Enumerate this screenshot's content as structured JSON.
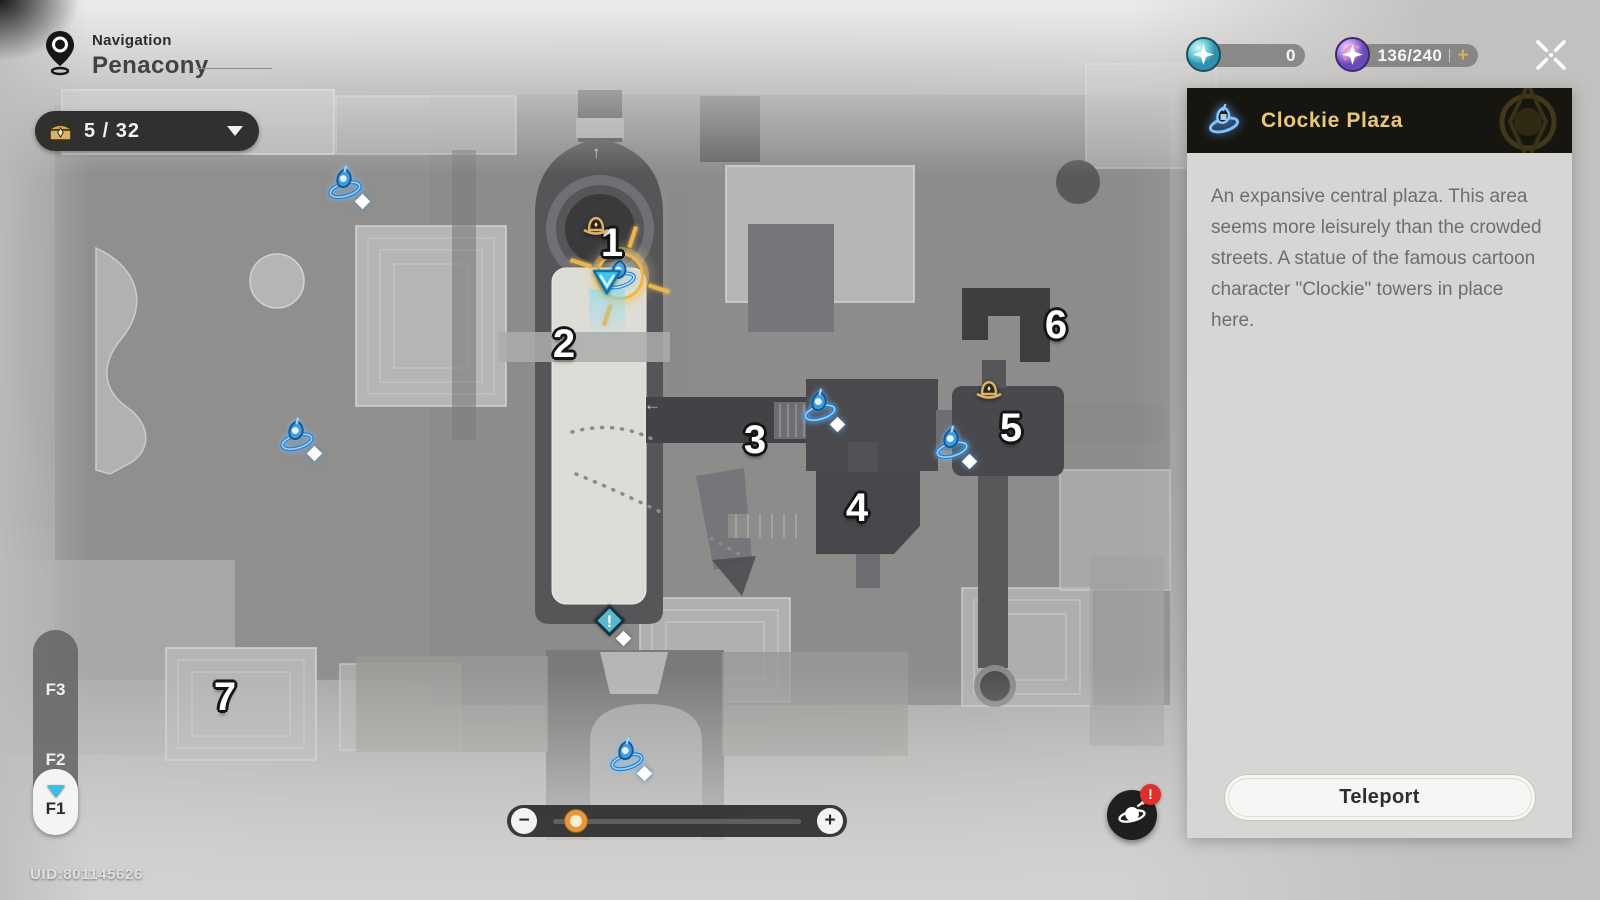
{
  "nav": {
    "label": "Navigation",
    "world": "Penacony"
  },
  "chest_counter": {
    "value": "5 / 32"
  },
  "currencies": [
    {
      "name": "fuel-orb",
      "value": "0"
    },
    {
      "name": "trailblaze-power-orb",
      "value": "136/240",
      "add_label": "+"
    }
  ],
  "panel": {
    "title": "Clockie Plaza",
    "description": "An expansive central plaza. This area seems more leisurely than the crowded streets. A statue of the famous cartoon character \"Clockie\" towers in place here.",
    "teleport_label": "Teleport"
  },
  "floor_selector": {
    "floors": [
      "F3",
      "F2"
    ],
    "active": "F1"
  },
  "zoom_control": {
    "minus": "−",
    "plus": "+",
    "value_pct": 5
  },
  "clockie_button": {
    "badge": "!"
  },
  "uid": "UID:801145626",
  "map": {
    "numbered_markers": [
      {
        "n": "1",
        "x": 612,
        "y": 243
      },
      {
        "n": "2",
        "x": 564,
        "y": 344
      },
      {
        "n": "3",
        "x": 755,
        "y": 440
      },
      {
        "n": "4",
        "x": 857,
        "y": 508
      },
      {
        "n": "5",
        "x": 1011,
        "y": 428
      },
      {
        "n": "6",
        "x": 1056,
        "y": 325
      },
      {
        "n": "7",
        "x": 225,
        "y": 697
      }
    ],
    "teleport_anchors": [
      {
        "x": 345,
        "y": 185
      },
      {
        "x": 297,
        "y": 437
      },
      {
        "x": 820,
        "y": 408
      },
      {
        "x": 952,
        "y": 445
      },
      {
        "x": 627,
        "y": 757
      }
    ],
    "selected_anchor": {
      "x": 620,
      "y": 276
    },
    "statues": [
      {
        "x": 596,
        "y": 227
      },
      {
        "x": 989,
        "y": 391
      }
    ],
    "player": {
      "x": 607,
      "y": 304
    },
    "alert_marker": {
      "x": 610,
      "y": 622,
      "glyph": "!"
    }
  },
  "colors": {
    "accent_gold": "#e5c87d",
    "anchor_blue": "#3f9ce0",
    "badge_red": "#dd2f2c",
    "knob_orange": "#e8973c"
  }
}
